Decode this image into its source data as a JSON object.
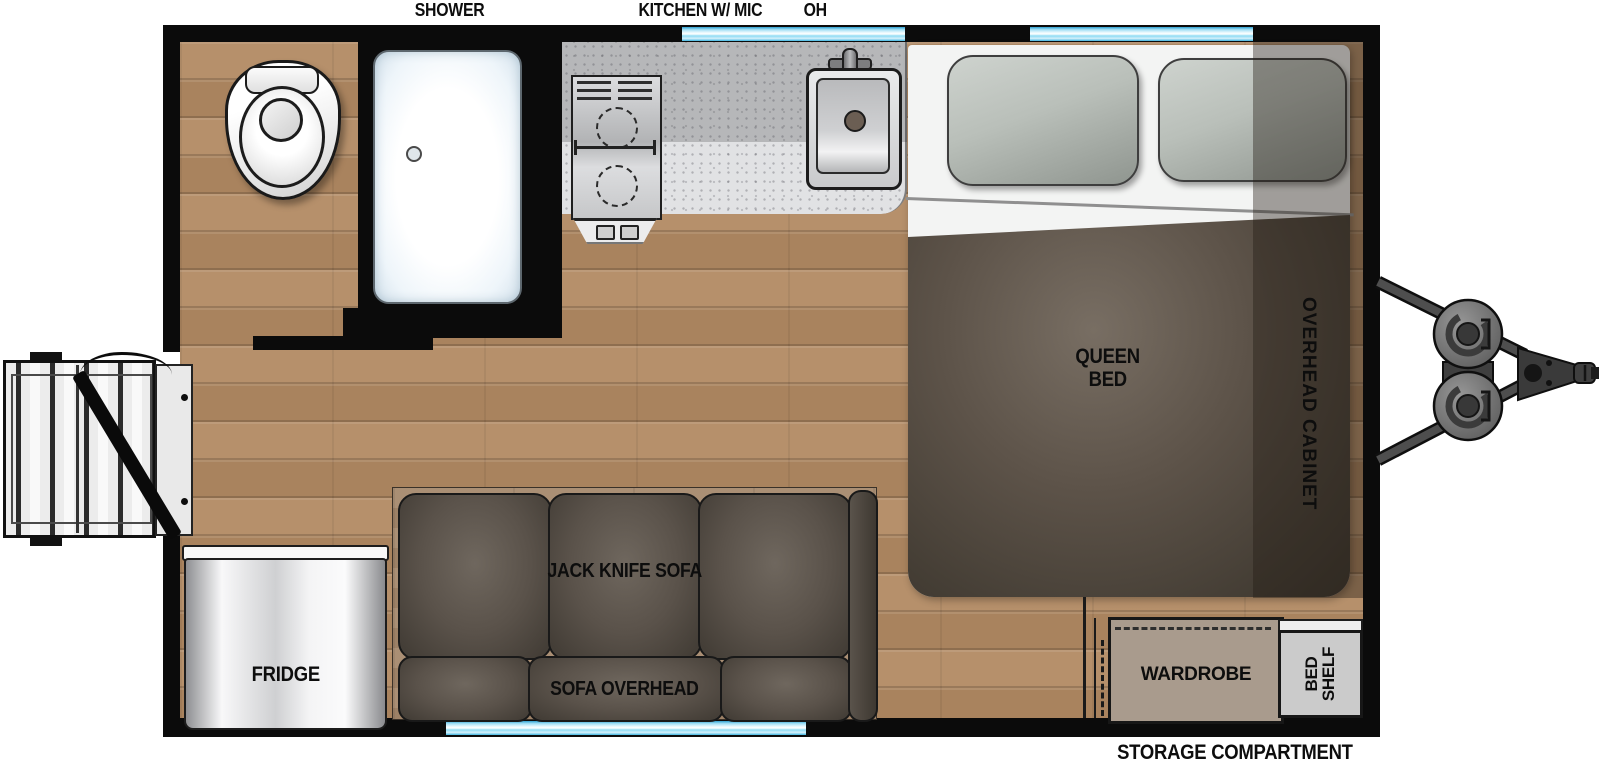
{
  "labels": {
    "shower": "SHOWER",
    "kitchen": "KITCHEN W/ MIC",
    "oh": "OH",
    "storage": "STORAGE COMPARTMENT"
  },
  "rooms": {
    "queen_bed_line1": "QUEEN",
    "queen_bed_line2": "BED",
    "overhead_cabinet": "OVERHEAD CABINET",
    "jack_knife_sofa": "JACK KNIFE SOFA",
    "sofa_overhead": "SOFA OVERHEAD",
    "fridge": "FRIDGE",
    "wardrobe": "WARDROBE",
    "bed_shelf_line1": "BED",
    "bed_shelf_line2": "SHELF"
  },
  "colors": {
    "wall": "#0b0b0b",
    "floor": "#b28a63",
    "window": "#5ec9ed",
    "counter": "#b8b9bb",
    "sheet": "#f3f4f3",
    "blanket": "#5a5148",
    "sofa": "#57504a",
    "platform": "#a5886c",
    "wardrobe": "#a99b8d",
    "shelf": "#cbcbcb",
    "fridge": "#d9dadb"
  }
}
